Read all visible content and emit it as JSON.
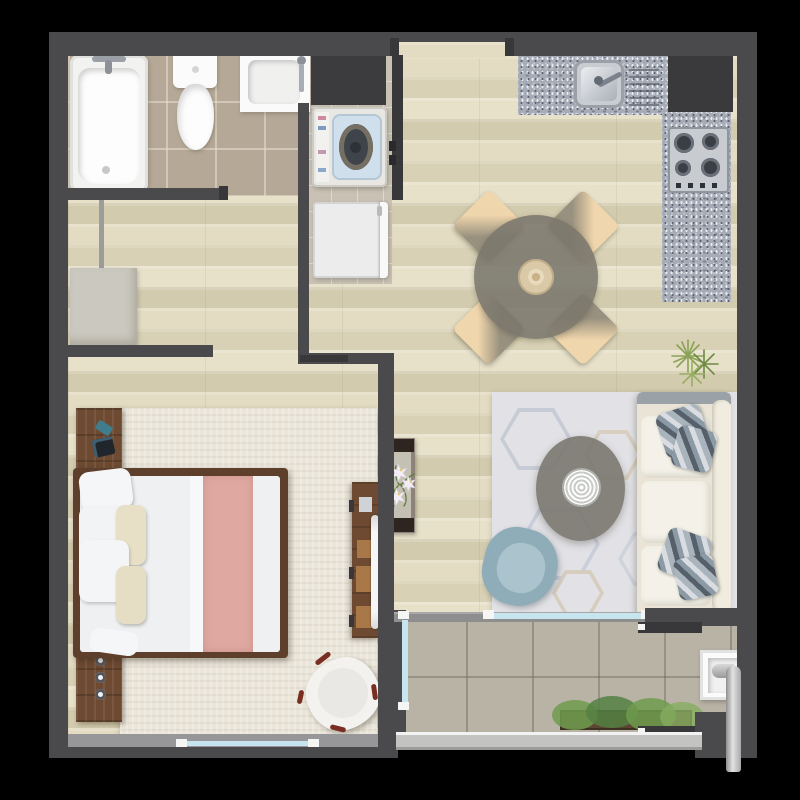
{
  "scene": {
    "kind": "apartment-floor-plan-top-down-render",
    "visible_text": "none",
    "background_color": "#000000",
    "wall_color": "#4a4a4c",
    "floor_colors": {
      "wood": "#ddd6bb",
      "bathroom_tile": "#b5a897",
      "service_tile": "#c9c2b4",
      "balcony_tile": "#b9b3a6",
      "granite_counter": "#a6abb5"
    },
    "accent_colors": {
      "bed_runner_pink": "#dfa9a2",
      "armchair_blue": "#93b2bd",
      "pillow_stripe_blue": "#55606b",
      "glass": "#c6e5ee",
      "wood_furniture": "#6d4a31",
      "plant_green": "#7d9a4e"
    },
    "rooms": [
      {
        "name": "bathroom",
        "items": [
          "bathtub",
          "toilet",
          "sink-vanity",
          "door-opening"
        ]
      },
      {
        "name": "laundry-closet",
        "items": [
          "upper-cabinet",
          "top-load-washing-machine",
          "closet-door",
          "refrigerator"
        ]
      },
      {
        "name": "dressing-area",
        "items": [
          "dresser",
          "clothes-rail"
        ]
      },
      {
        "name": "kitchen",
        "items": [
          "granite-l-counter",
          "steel-sink",
          "drainboard",
          "gas-cooktop-4-burner",
          "dark-corner-cabinet"
        ]
      },
      {
        "name": "dining-area",
        "items": [
          "round-table",
          "chair-nw",
          "chair-ne",
          "chair-sw",
          "chair-se",
          "centerpiece"
        ]
      },
      {
        "name": "living-room",
        "items": [
          "hexagon-rug",
          "coffee-table",
          "round-tray",
          "sofa-3-seat",
          "striped-pillows-x4",
          "blue-armchair",
          "plant"
        ]
      },
      {
        "name": "hallway",
        "items": [
          "entrance-opening",
          "console-table-with-lilies"
        ]
      },
      {
        "name": "bedroom",
        "items": [
          "area-rug",
          "headboard-panel",
          "double-bed",
          "pink-runner",
          "pillows",
          "tv-console",
          "tv",
          "accent-chair",
          "window"
        ]
      },
      {
        "name": "balcony",
        "items": [
          "sliding-glass-door",
          "planter-box",
          "laundry-sink",
          "drain-pipe",
          "glass-railing",
          "door-tracks"
        ]
      }
    ]
  }
}
